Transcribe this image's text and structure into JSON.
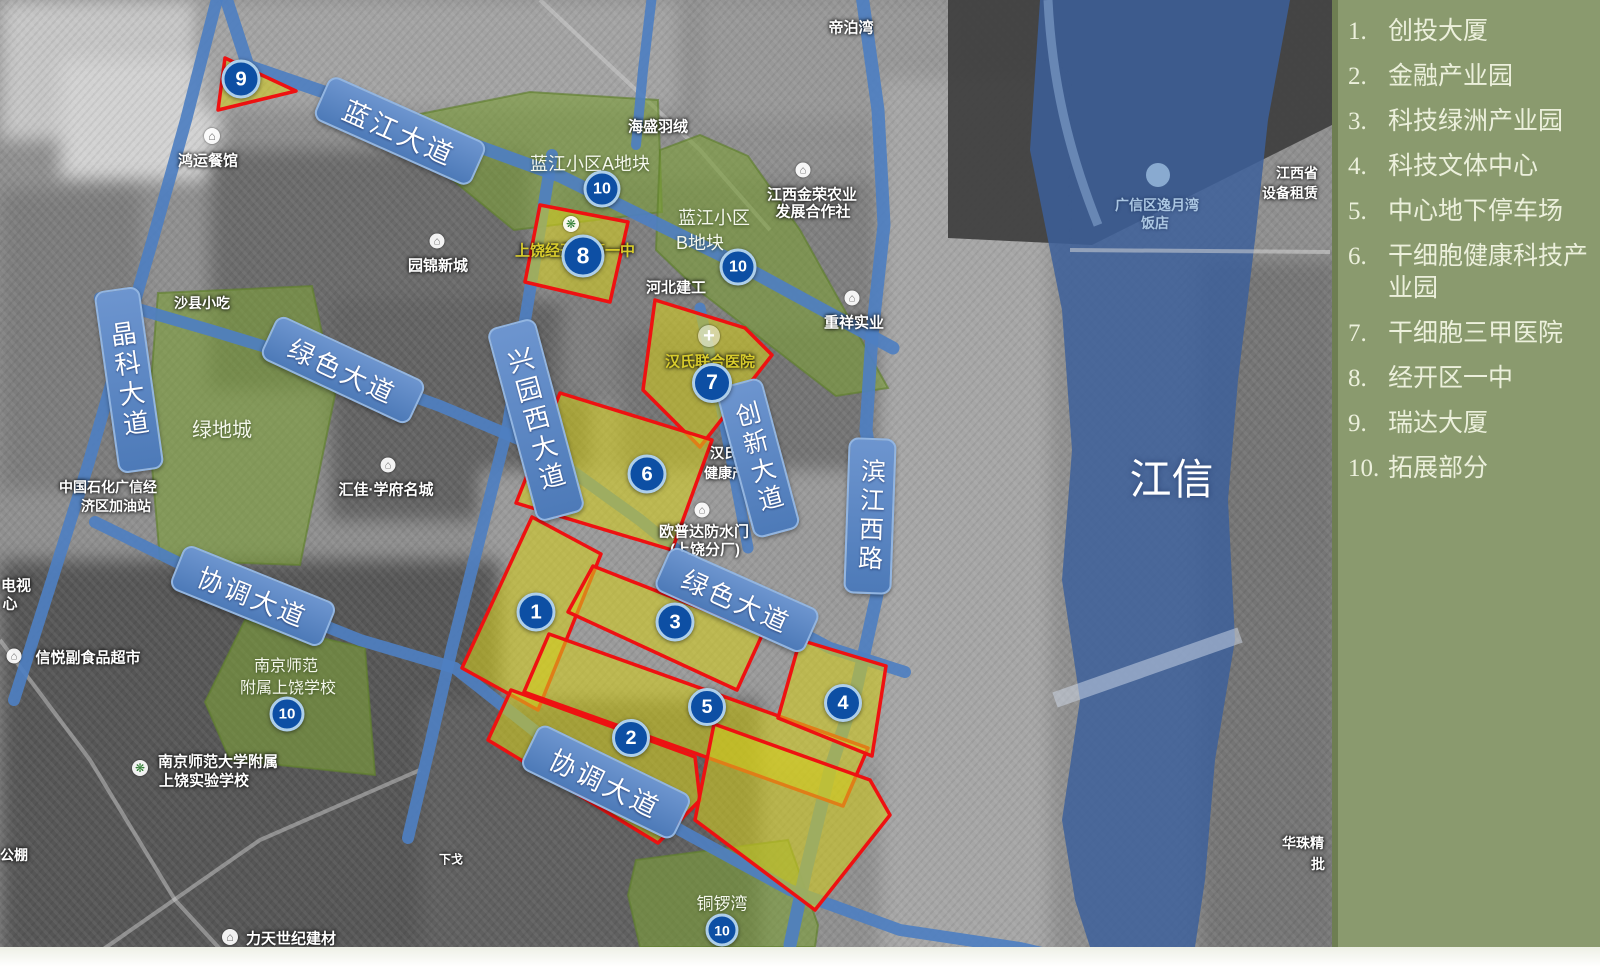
{
  "colors": {
    "legend_bg": "#8a9a6e",
    "road": "#4e7fc1",
    "pill_fill": "#5b87c6",
    "pill_border": "#92b5e1",
    "river": "#3b5f9b",
    "yellow_zone": "rgba(212,205,30,0.58)",
    "zone_border": "#ee1111",
    "green_zone": "rgba(124,158,58,0.62)",
    "marker": "#0d4fa4",
    "marker_ring": "#aecfea"
  },
  "legend": {
    "items": [
      {
        "num": "1.",
        "label": "创投大厦"
      },
      {
        "num": "2.",
        "label": "金融产业园"
      },
      {
        "num": "3.",
        "label": "科技绿洲产业园"
      },
      {
        "num": "4.",
        "label": "科技文体中心"
      },
      {
        "num": "5.",
        "label": "中心地下停车场"
      },
      {
        "num": "6.",
        "label": "干细胞健康科技产业园"
      },
      {
        "num": "7.",
        "label": "干细胞三甲医院"
      },
      {
        "num": "8.",
        "label": "经开区一中"
      },
      {
        "num": "9.",
        "label": "瑞达大厦"
      },
      {
        "num": "10.",
        "label": "拓展部分"
      }
    ]
  },
  "river": {
    "name": "信江",
    "x": 1168,
    "y": 478
  },
  "road_labels": [
    {
      "text": "蓝江大道",
      "x": 398,
      "y": 129,
      "w": 168,
      "h": 44,
      "rot": 24,
      "v": false,
      "fs": 27
    },
    {
      "text": "晶科大道",
      "x": 127,
      "y": 378,
      "w": 42,
      "h": 180,
      "rot": -8,
      "v": true,
      "fs": 26
    },
    {
      "text": "绿色大道",
      "x": 341,
      "y": 368,
      "w": 160,
      "h": 44,
      "rot": 25,
      "v": false,
      "fs": 26
    },
    {
      "text": "兴园西大道",
      "x": 534,
      "y": 418,
      "w": 46,
      "h": 196,
      "rot": -15,
      "v": true,
      "fs": 26
    },
    {
      "text": "创新大道",
      "x": 756,
      "y": 456,
      "w": 44,
      "h": 152,
      "rot": -15,
      "v": true,
      "fs": 25
    },
    {
      "text": "滨江西路",
      "x": 868,
      "y": 514,
      "w": 44,
      "h": 152,
      "rot": 2,
      "v": true,
      "fs": 25
    },
    {
      "text": "协调大道",
      "x": 251,
      "y": 594,
      "w": 160,
      "h": 44,
      "rot": 22,
      "v": false,
      "fs": 26
    },
    {
      "text": "绿色大道",
      "x": 735,
      "y": 598,
      "w": 160,
      "h": 44,
      "rot": 24,
      "v": false,
      "fs": 26
    },
    {
      "text": "协调大道",
      "x": 604,
      "y": 780,
      "w": 166,
      "h": 46,
      "rot": 26,
      "v": false,
      "fs": 27
    }
  ],
  "markers": [
    {
      "n": "9",
      "x": 241,
      "y": 79,
      "d": 33
    },
    {
      "n": "10",
      "x": 602,
      "y": 189,
      "d": 31
    },
    {
      "n": "8",
      "x": 583,
      "y": 256,
      "d": 37
    },
    {
      "n": "10",
      "x": 738,
      "y": 267,
      "d": 31
    },
    {
      "n": "7",
      "x": 712,
      "y": 383,
      "d": 34
    },
    {
      "n": "6",
      "x": 647,
      "y": 474,
      "d": 33
    },
    {
      "n": "1",
      "x": 536,
      "y": 612,
      "d": 33
    },
    {
      "n": "3",
      "x": 675,
      "y": 622,
      "d": 33
    },
    {
      "n": "5",
      "x": 707,
      "y": 707,
      "d": 32
    },
    {
      "n": "2",
      "x": 631,
      "y": 738,
      "d": 32
    },
    {
      "n": "4",
      "x": 843,
      "y": 703,
      "d": 32
    },
    {
      "n": "10",
      "x": 287,
      "y": 714,
      "d": 29
    },
    {
      "n": "10",
      "x": 722,
      "y": 930,
      "d": 27
    }
  ],
  "green_zones": [
    {
      "id": "lanjiang-a",
      "points": "400,118 530,92 658,100 662,212 514,230 428,160",
      "labels": [
        {
          "t": "蓝江小区A地块",
          "x": 590,
          "y": 163,
          "fs": 18
        }
      ]
    },
    {
      "id": "lanjiang-b",
      "points": "660,150 700,135 748,156 800,230 888,388 836,396 698,290 656,250",
      "labels": [
        {
          "t": "蓝江小区",
          "x": 714,
          "y": 217,
          "fs": 18
        },
        {
          "t": "B地块",
          "x": 700,
          "y": 242,
          "fs": 18
        }
      ]
    },
    {
      "id": "lvdicheng",
      "points": "158,293 312,286 335,395 300,565 160,560 148,420",
      "labels": [
        {
          "t": "绿地城",
          "x": 222,
          "y": 428,
          "fs": 20
        }
      ]
    },
    {
      "id": "nanjingshifan",
      "points": "245,620 365,648 375,775 230,760 205,702",
      "labels": [
        {
          "t": "南京师范",
          "x": 286,
          "y": 664,
          "fs": 16
        },
        {
          "t": "附属上饶学校",
          "x": 288,
          "y": 686,
          "fs": 16
        }
      ]
    },
    {
      "id": "tongluowan",
      "points": "636,860 788,840 818,925 815,947 640,947 628,895",
      "labels": [
        {
          "t": "铜锣湾",
          "x": 722,
          "y": 902,
          "fs": 17
        }
      ]
    }
  ],
  "yellow_zones": [
    {
      "id": "9",
      "points": "225,58 296,91 218,110"
    },
    {
      "id": "8",
      "points": "540,205 628,222 610,302 525,282"
    },
    {
      "id": "7",
      "points": "655,300 745,328 772,355 700,447 643,390"
    },
    {
      "id": "6",
      "points": "560,393 712,440 672,550 516,503"
    },
    {
      "id": "1",
      "points": "532,517 601,554 538,710 462,668"
    },
    {
      "id": "3",
      "points": "593,566 763,633 737,690 568,612"
    },
    {
      "id": "5",
      "points": "549,634 868,748 843,806 524,692"
    },
    {
      "id": "2",
      "points": "511,690 695,757 700,800 658,843 488,740"
    },
    {
      "id": "4-5-ext",
      "points": "714,724 870,780 890,815 815,910 695,820"
    },
    {
      "id": "4",
      "points": "800,640 886,666 872,756 778,718"
    }
  ],
  "roads": [
    {
      "id": "lanjiang-avenue",
      "pts": [
        [
          225,
          -5
        ],
        [
          248,
          66
        ],
        [
          400,
          118
        ],
        [
          560,
          176
        ],
        [
          735,
          262
        ],
        [
          893,
          348
        ]
      ],
      "w": 13
    },
    {
      "id": "jingke-avenue",
      "pts": [
        [
          218,
          -5
        ],
        [
          186,
          120
        ],
        [
          152,
          242
        ],
        [
          118,
          360
        ],
        [
          88,
          465
        ],
        [
          52,
          580
        ],
        [
          14,
          700
        ]
      ],
      "w": 12
    },
    {
      "id": "lvse-avenue-west",
      "pts": [
        [
          100,
          298
        ],
        [
          210,
          330
        ],
        [
          335,
          368
        ],
        [
          440,
          406
        ],
        [
          540,
          448
        ]
      ],
      "w": 12
    },
    {
      "id": "xingyuanxi-avenue",
      "pts": [
        [
          552,
          155
        ],
        [
          530,
          290
        ],
        [
          508,
          425
        ],
        [
          478,
          545
        ],
        [
          452,
          648
        ],
        [
          430,
          745
        ],
        [
          408,
          838
        ]
      ],
      "w": 12
    },
    {
      "id": "chuangxin-avenue",
      "pts": [
        [
          700,
          308
        ],
        [
          724,
          420
        ],
        [
          748,
          548
        ]
      ],
      "w": 11
    },
    {
      "id": "lvse-avenue-east",
      "pts": [
        [
          540,
          448
        ],
        [
          640,
          520
        ],
        [
          735,
          598
        ],
        [
          830,
          648
        ],
        [
          905,
          672
        ]
      ],
      "w": 12
    },
    {
      "id": "binjiangxi-road",
      "pts": [
        [
          862,
          -5
        ],
        [
          878,
          110
        ],
        [
          884,
          225
        ],
        [
          872,
          335
        ],
        [
          866,
          430
        ],
        [
          880,
          520
        ],
        [
          878,
          590
        ],
        [
          856,
          690
        ],
        [
          830,
          770
        ],
        [
          806,
          870
        ],
        [
          790,
          945
        ]
      ],
      "w": 13
    },
    {
      "id": "xietiao-avenue",
      "pts": [
        [
          95,
          522
        ],
        [
          230,
          588
        ],
        [
          360,
          640
        ],
        [
          455,
          668
        ],
        [
          540,
          735
        ],
        [
          604,
          780
        ],
        [
          680,
          830
        ],
        [
          790,
          890
        ],
        [
          900,
          930
        ],
        [
          1020,
          948
        ],
        [
          1072,
          960
        ]
      ],
      "w": 12
    },
    {
      "id": "north-link",
      "pts": [
        [
          652,
          -5
        ],
        [
          643,
          70
        ],
        [
          636,
          145
        ]
      ],
      "w": 10
    }
  ],
  "map_labels": [
    {
      "t": "帝泊湾",
      "x": 851,
      "y": 27,
      "fs": 15,
      "c": "w"
    },
    {
      "t": "海盛羽绒",
      "x": 658,
      "y": 126,
      "fs": 15,
      "c": "w"
    },
    {
      "t": "鸿运餐馆",
      "x": 208,
      "y": 160,
      "fs": 15,
      "c": "w"
    },
    {
      "t": "园锦新城",
      "x": 438,
      "y": 265,
      "fs": 15,
      "c": "w"
    },
    {
      "t": "江西金荣农业",
      "x": 812,
      "y": 194,
      "fs": 15,
      "c": "w"
    },
    {
      "t": "发展合作社",
      "x": 813,
      "y": 211,
      "fs": 15,
      "c": "w"
    },
    {
      "t": "河北建工",
      "x": 676,
      "y": 287,
      "fs": 15,
      "c": "w"
    },
    {
      "t": "重祥实业",
      "x": 854,
      "y": 322,
      "fs": 15,
      "c": "w"
    },
    {
      "t": "汇佳·学府名城",
      "x": 386,
      "y": 489,
      "fs": 15,
      "c": "w"
    },
    {
      "t": "中国石化广信经",
      "x": 108,
      "y": 487,
      "fs": 14,
      "c": "w"
    },
    {
      "t": "济区加油站",
      "x": 116,
      "y": 506,
      "fs": 14,
      "c": "w"
    },
    {
      "t": "沙县小吃",
      "x": 202,
      "y": 303,
      "fs": 14,
      "c": "w"
    },
    {
      "t": "信悦副食品超市",
      "x": 88,
      "y": 657,
      "fs": 15,
      "c": "w"
    },
    {
      "t": "电视",
      "x": 16,
      "y": 585,
      "fs": 15,
      "c": "w"
    },
    {
      "t": "心",
      "x": 10,
      "y": 603,
      "fs": 15,
      "c": "w"
    },
    {
      "t": "南京师范大学附属",
      "x": 218,
      "y": 761,
      "fs": 15,
      "c": "w"
    },
    {
      "t": "上饶实验学校",
      "x": 204,
      "y": 780,
      "fs": 15,
      "c": "w"
    },
    {
      "t": "力天世纪建材",
      "x": 291,
      "y": 938,
      "fs": 15,
      "c": "w"
    },
    {
      "t": "下戈",
      "x": 451,
      "y": 859,
      "fs": 12,
      "c": "w"
    },
    {
      "t": "公棚",
      "x": 14,
      "y": 855,
      "fs": 14,
      "c": "w"
    },
    {
      "t": "华珠精",
      "x": 1303,
      "y": 843,
      "fs": 14,
      "c": "w"
    },
    {
      "t": "批",
      "x": 1318,
      "y": 864,
      "fs": 14,
      "c": "w"
    },
    {
      "t": "江西省",
      "x": 1297,
      "y": 173,
      "fs": 14,
      "c": "w"
    },
    {
      "t": "设备租赁",
      "x": 1290,
      "y": 193,
      "fs": 14,
      "c": "w"
    },
    {
      "t": "广信区逸月湾",
      "x": 1157,
      "y": 205,
      "fs": 14,
      "c": "b"
    },
    {
      "t": "饭店",
      "x": 1155,
      "y": 223,
      "fs": 14,
      "c": "b"
    },
    {
      "t": "汉氏",
      "x": 724,
      "y": 453,
      "fs": 14,
      "c": "w"
    },
    {
      "t": "健康产业园",
      "x": 739,
      "y": 473,
      "fs": 14,
      "c": "w"
    },
    {
      "t": "欧普达防水门",
      "x": 704,
      "y": 531,
      "fs": 15,
      "c": "w"
    },
    {
      "t": "(上饶分厂)",
      "x": 705,
      "y": 549,
      "fs": 15,
      "c": "w"
    },
    {
      "t": "汉氏联合医院",
      "x": 710,
      "y": 361,
      "fs": 15,
      "c": "y"
    },
    {
      "t": "上饶经开区第一中",
      "x": 575,
      "y": 250,
      "fs": 15,
      "c": "y"
    }
  ],
  "poi_icons": [
    {
      "name": "restaurant-icon",
      "x": 212,
      "y": 136,
      "d": 16,
      "g": "⌂",
      "col": "#6b6b6b"
    },
    {
      "name": "building-icon",
      "x": 437,
      "y": 241,
      "d": 15,
      "g": "⌂",
      "col": "#6b6b6b"
    },
    {
      "name": "building-icon",
      "x": 803,
      "y": 170,
      "d": 15,
      "g": "⌂",
      "col": "#6b6b6b"
    },
    {
      "name": "building-icon",
      "x": 852,
      "y": 298,
      "d": 15,
      "g": "⌂",
      "col": "#6b6b6b"
    },
    {
      "name": "building-icon",
      "x": 702,
      "y": 510,
      "d": 15,
      "g": "⌂",
      "col": "#6b6b6b"
    },
    {
      "name": "building-icon",
      "x": 388,
      "y": 465,
      "d": 15,
      "g": "⌂",
      "col": "#6b6b6b"
    },
    {
      "name": "supermarket-icon",
      "x": 14,
      "y": 656,
      "d": 15,
      "g": "⌂",
      "col": "#6b6b6b"
    },
    {
      "name": "school-icon",
      "x": 140,
      "y": 768,
      "d": 16,
      "g": "❋",
      "col": "#2f7d32"
    },
    {
      "name": "building-icon",
      "x": 230,
      "y": 937,
      "d": 16,
      "g": "⌂",
      "col": "#6b6b6b"
    },
    {
      "name": "school-icon",
      "x": 571,
      "y": 224,
      "d": 16,
      "g": "❋",
      "col": "#2f7d32"
    },
    {
      "name": "hospital-cross-icon",
      "x": 709,
      "y": 336,
      "d": 22,
      "g": "+",
      "col": "#ffffff"
    }
  ]
}
